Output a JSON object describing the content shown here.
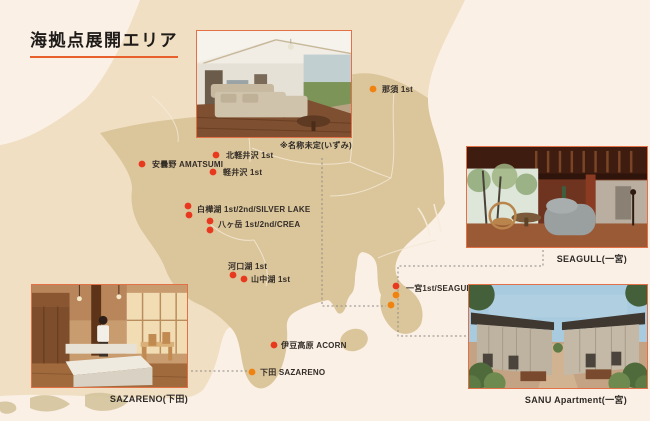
{
  "title": "海拠点展開エリア",
  "colors": {
    "background": "#FAF0E6",
    "land_outer": "#F0DFC3",
    "land_kanto": "#DBC59B",
    "accent_underline": "#E8612C",
    "photo_border": "#E27147",
    "dot_red": "#E8391E",
    "dot_orange": "#F0820F",
    "connector": "#8F8A84",
    "text": "#332D27"
  },
  "markers": [
    {
      "name": "nasu",
      "label": "那須 1st",
      "label_x": 382,
      "label_y": 92,
      "dots": [
        {
          "x": 373,
          "y": 89,
          "c": "orange"
        }
      ]
    },
    {
      "name": "kita-karuizawa",
      "label": "北軽井沢 1st",
      "label_x": 226,
      "label_y": 158,
      "dots": [
        {
          "x": 216,
          "y": 155,
          "c": "red"
        }
      ]
    },
    {
      "name": "azumino",
      "label": "安曇野 AMATSUMI",
      "label_x": 152,
      "label_y": 167,
      "dots": [
        {
          "x": 142,
          "y": 164,
          "c": "red"
        }
      ]
    },
    {
      "name": "karuizawa",
      "label": "軽井沢 1st",
      "label_x": 223,
      "label_y": 175,
      "dots": [
        {
          "x": 213,
          "y": 172,
          "c": "red"
        }
      ]
    },
    {
      "name": "shirakabako",
      "label": "白樺湖 1st/2nd/SILVER LAKE",
      "label_x": 197,
      "label_y": 212,
      "dots": [
        {
          "x": 188,
          "y": 206,
          "c": "red"
        },
        {
          "x": 189,
          "y": 215,
          "c": "red"
        }
      ]
    },
    {
      "name": "yatsugatake",
      "label": "八ヶ岳 1st/2nd/CREA",
      "label_x": 218,
      "label_y": 227,
      "dots": [
        {
          "x": 210,
          "y": 221,
          "c": "red"
        },
        {
          "x": 210,
          "y": 230,
          "c": "red"
        }
      ]
    },
    {
      "name": "kawaguchiko",
      "label": "河口湖 1st",
      "label_x": 228,
      "label_y": 269,
      "dots": [
        {
          "x": 233,
          "y": 275,
          "c": "red"
        }
      ]
    },
    {
      "name": "yamanakako",
      "label": "山中湖 1st",
      "label_x": 251,
      "label_y": 282,
      "dots": [
        {
          "x": 244,
          "y": 279,
          "c": "red"
        }
      ]
    },
    {
      "name": "izukogen",
      "label": "伊豆高原 ACORN",
      "label_x": 281,
      "label_y": 348,
      "dots": [
        {
          "x": 274,
          "y": 345,
          "c": "red"
        }
      ]
    },
    {
      "name": "shimoda",
      "label": "下田 SAZARENO",
      "label_x": 260,
      "label_y": 375,
      "dots": [
        {
          "x": 252,
          "y": 372,
          "c": "orange"
        }
      ]
    },
    {
      "name": "ichinomiya",
      "label": "一宮1st/SEAGULL",
      "label_x": 406,
      "label_y": 291,
      "dots": [
        {
          "x": 396,
          "y": 286,
          "c": "red"
        },
        {
          "x": 396,
          "y": 295,
          "c": "orange"
        },
        {
          "x": 391,
          "y": 305,
          "c": "orange"
        }
      ]
    }
  ],
  "connectors": [
    {
      "name": "izumi-connector",
      "points": [
        [
          322,
          158
        ],
        [
          322,
          306
        ],
        [
          386,
          306
        ]
      ]
    },
    {
      "name": "seagull-sanu-connector",
      "points": [
        [
          543,
          250
        ],
        [
          543,
          266
        ],
        [
          398,
          266
        ],
        [
          398,
          336
        ],
        [
          466,
          336
        ]
      ]
    },
    {
      "name": "sazareno-connector",
      "points": [
        [
          191,
          371
        ],
        [
          247,
          371
        ]
      ]
    }
  ],
  "photos": [
    {
      "name": "izumi",
      "caption": "※名称未定(いずみ)"
    },
    {
      "name": "seagull",
      "caption": "SEAGULL(一宮)"
    },
    {
      "name": "sanu",
      "caption": "SANU Apartment(一宮)"
    },
    {
      "name": "sazareno",
      "caption": "SAZARENO(下田)"
    }
  ]
}
